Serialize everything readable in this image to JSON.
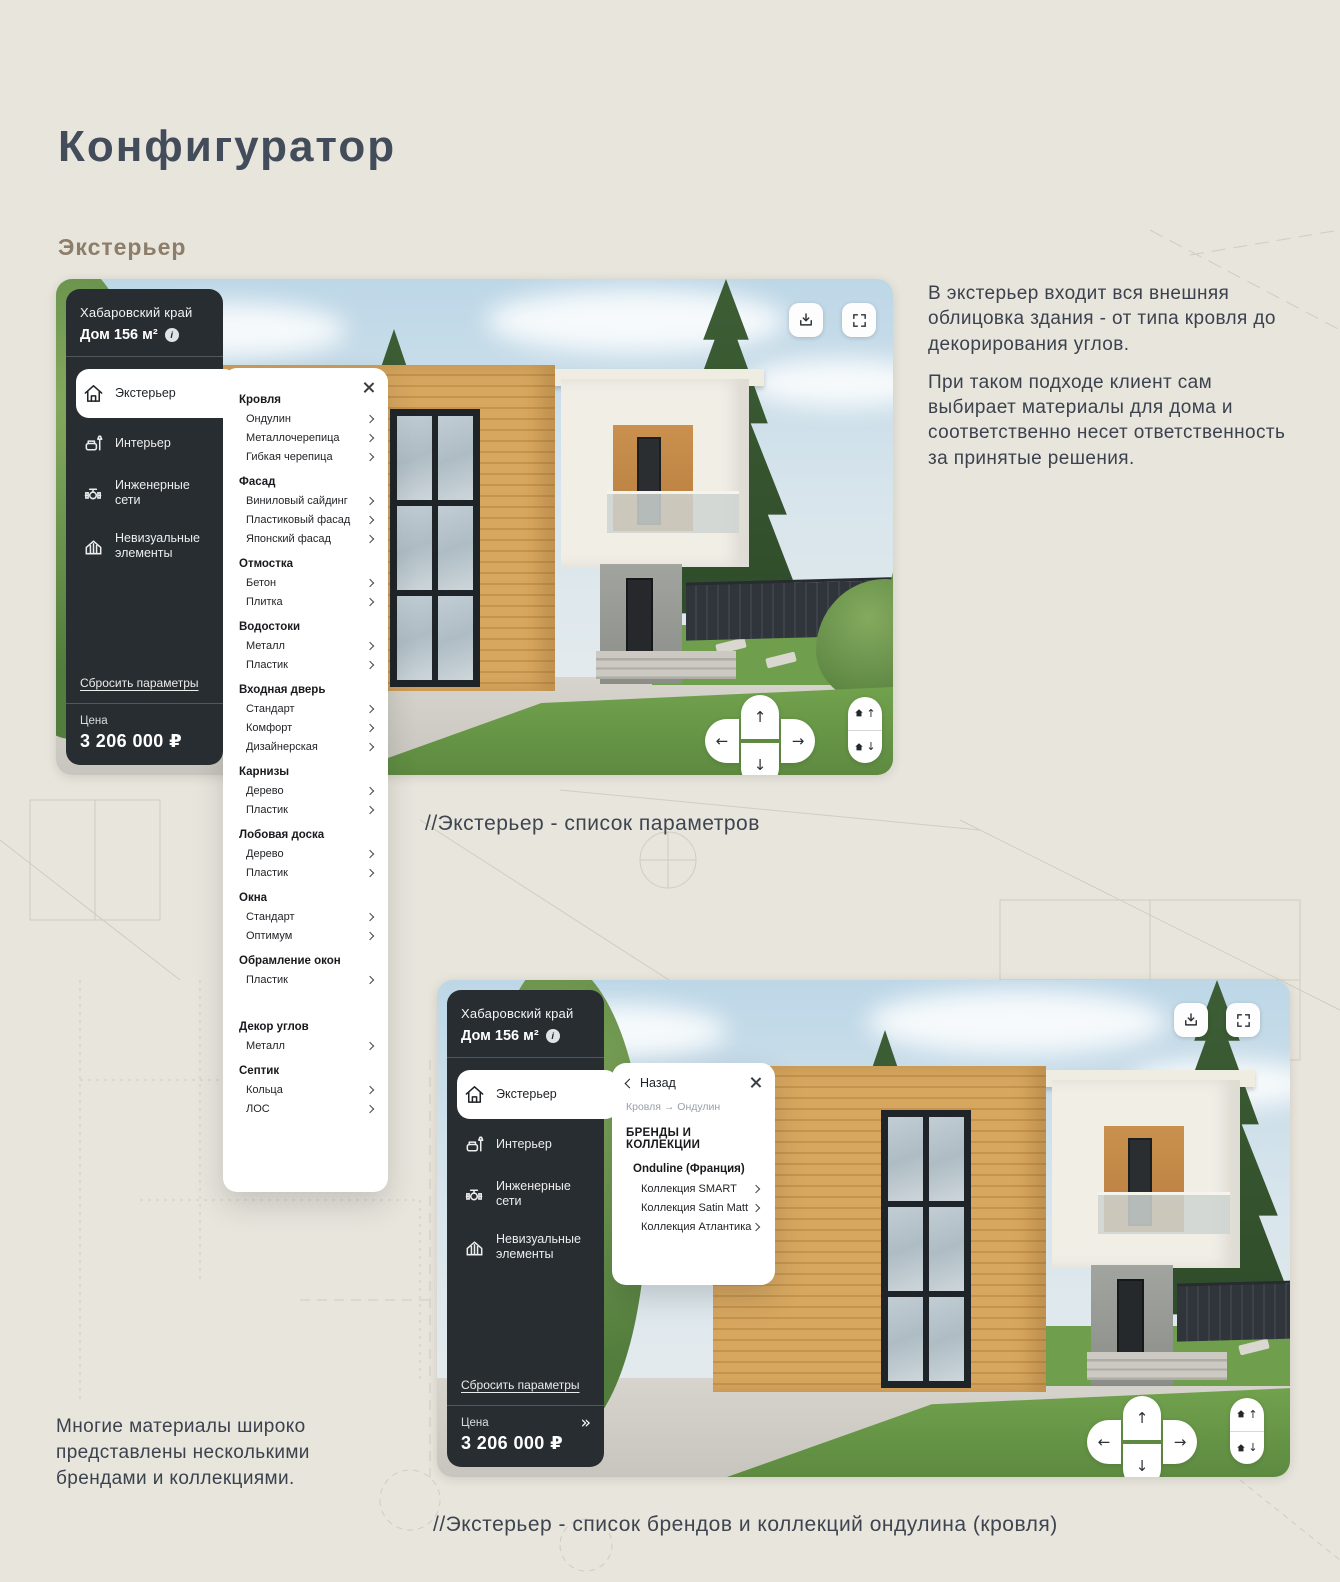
{
  "page": {
    "title": "Конфигуратор",
    "subtitle": "Экстерьер",
    "intro_par_1": "В экстерьер входит вся внешняя облицовка здания - от типа кровля до декорирования углов.",
    "intro_par_2": "При таком подходе клиент сам выбирает материалы для дома и соответственно несет ответственность за принятые решения.",
    "note": "Многие материалы широко представлены несколькими брендами и коллекциями.",
    "caption_shot1": "//Экстерьер - список параметров",
    "caption_shot2": "//Экстерьер - список брендов и коллекций ондулина (кровля)"
  },
  "configurator": {
    "location": "Хабаровский край",
    "house": "Дом 156 м²",
    "menu": [
      {
        "label": "Экстерьер",
        "icon": "home-icon",
        "active": true
      },
      {
        "label": "Интерьер",
        "icon": "armchair-icon",
        "active": false
      },
      {
        "label": "Инженерные сети",
        "icon": "valve-icon",
        "active": false
      },
      {
        "label": "Невизуальные элементы",
        "icon": "fence-icon",
        "active": false
      }
    ],
    "reset_label": "Сбросить параметры",
    "price_label": "Цена",
    "price_value": "3 206 000 ₽",
    "controls": {
      "up": "↑",
      "down": "↓",
      "left": "←",
      "right": "→",
      "expand": "»",
      "info": "i"
    }
  },
  "params_panel": {
    "sections": [
      {
        "title": "Кровля",
        "items": [
          "Ондулин",
          "Металлочерепица",
          "Гибкая черепица"
        ]
      },
      {
        "title": "Фасад",
        "items": [
          "Виниловый сайдинг",
          "Пластиковый фасад",
          "Японский фасад"
        ]
      },
      {
        "title": "Отмостка",
        "items": [
          "Бетон",
          "Плитка"
        ]
      },
      {
        "title": "Водостоки",
        "items": [
          "Металл",
          "Пластик"
        ]
      },
      {
        "title": "Входная дверь",
        "items": [
          "Стандарт",
          "Комфорт",
          "Дизайнерская"
        ]
      },
      {
        "title": "Карнизы",
        "items": [
          "Дерево",
          "Пластик"
        ]
      },
      {
        "title": "Лобовая доска",
        "items": [
          "Дерево",
          "Пластик"
        ]
      },
      {
        "title": "Окна",
        "items": [
          "Стандарт",
          "Оптимум"
        ]
      },
      {
        "title": "Обрамление окон",
        "items": [
          "Пластик"
        ]
      },
      {
        "title": "Декор углов",
        "items": [
          "Металл"
        ],
        "gap_before": true
      },
      {
        "title": "Септик",
        "items": [
          "Кольца",
          "ЛОС"
        ]
      }
    ]
  },
  "brands_panel": {
    "back_label": "Назад",
    "breadcrumb": "Кровля → Ондулин",
    "title": "БРЕНДЫ И КОЛЛЕКЦИИ",
    "brand": "Onduline (Франция)",
    "collections": [
      "Коллекция SMART",
      "Коллекция Satin Matt",
      "Коллекция Атлантика"
    ]
  }
}
